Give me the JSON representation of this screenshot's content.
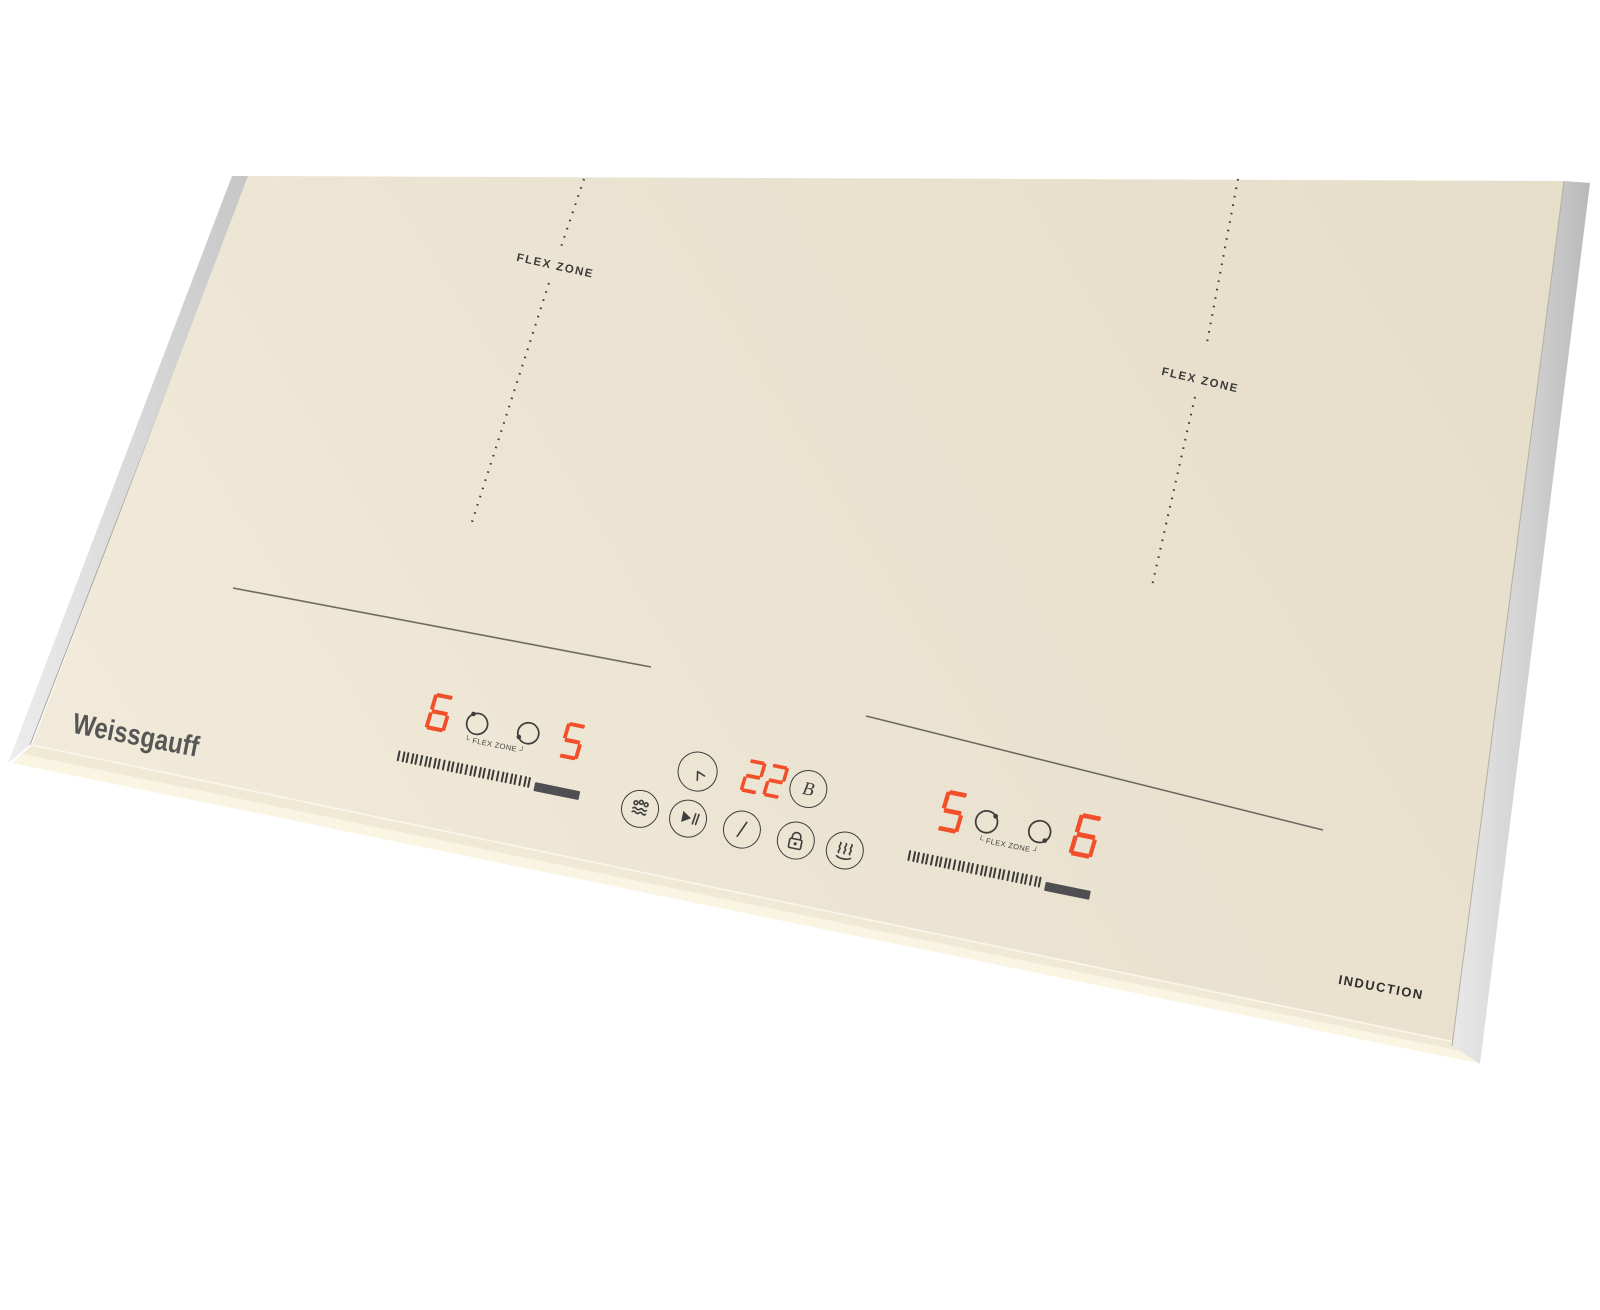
{
  "brand": "Weissgauff",
  "induction_label": "INDUCTION",
  "surface_labels": {
    "left_flex": "FLEX ZONE",
    "right_flex": "FLEX ZONE"
  },
  "left_control": {
    "rear_level": "6",
    "front_level": "5",
    "flex_label": "└ FLEX ZONE ┘",
    "slider_ticks": 30
  },
  "center_control": {
    "timer_value": "22",
    "boost_label": "B"
  },
  "right_control": {
    "rear_level": "5",
    "front_level": "6",
    "flex_label": "└ FLEX ZONE ┘",
    "slider_ticks": 30
  },
  "icons": {
    "timer": "clock-icon",
    "boost": "letter-b-icon",
    "boil": "bubbles-over-waves-icon",
    "start_pause": "play-pause-icon",
    "power": "power-slash-icon",
    "lock": "padlock-icon",
    "keep_warm": "steam-over-dish-icon",
    "burner_select": "ring-with-dot-icon"
  },
  "colors": {
    "display_red": "#F1502A",
    "surface_beige": "#ECE4D1",
    "bevel_cream": "#F8F2E0",
    "trim_silver": "#D9D9D9",
    "graphics_dark": "#3E3E3C",
    "slider_bar": "#4F4E53",
    "background": "#FFFFFF"
  }
}
